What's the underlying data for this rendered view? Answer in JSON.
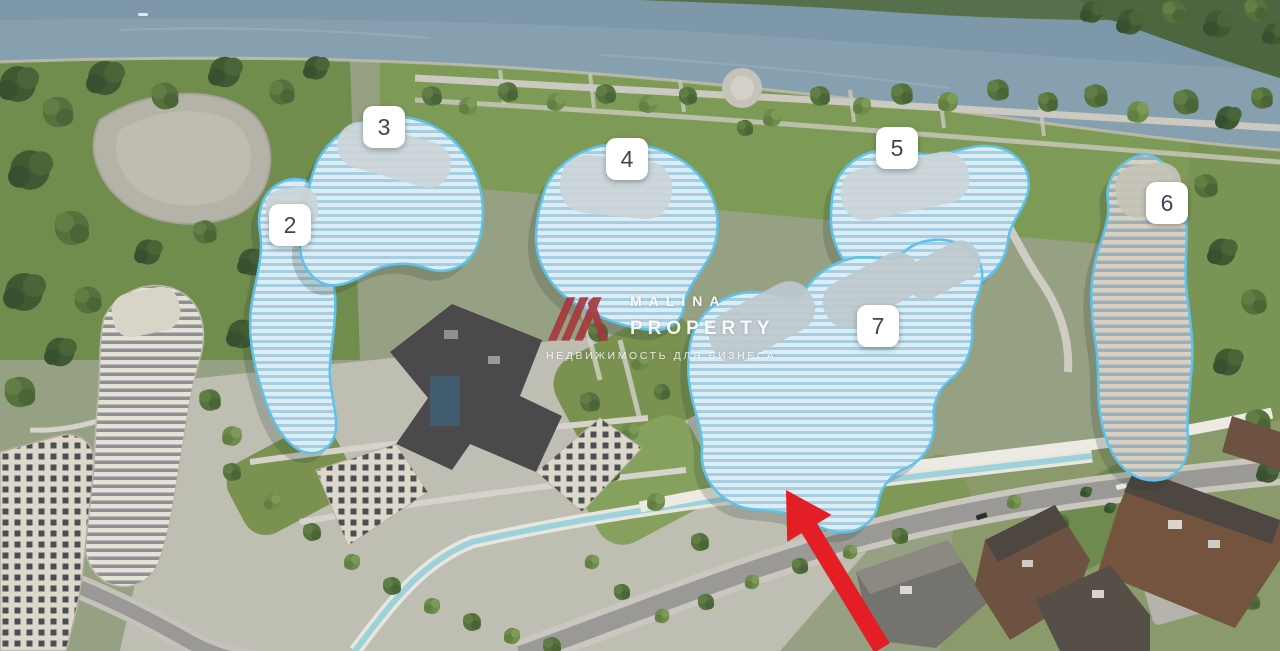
{
  "buildings": [
    {
      "label": "2"
    },
    {
      "label": "3"
    },
    {
      "label": "4"
    },
    {
      "label": "5"
    },
    {
      "label": "6"
    },
    {
      "label": "7"
    }
  ],
  "watermark": {
    "brand_line1": "MALINA",
    "brand_line2": "PROPERTY",
    "tagline": "НЕДВИЖИМОСТЬ ДЛЯ БИЗНЕСА"
  },
  "annotations": {
    "arrow_color": "#e31e24"
  },
  "colors": {
    "highlight_outline": "#5ec3ec",
    "label_bg": "#ffffff",
    "label_text": "#3c4657",
    "watermark_text": "#ffffff",
    "watermark_logo": "#a8383e",
    "water": "#86a0b0"
  }
}
